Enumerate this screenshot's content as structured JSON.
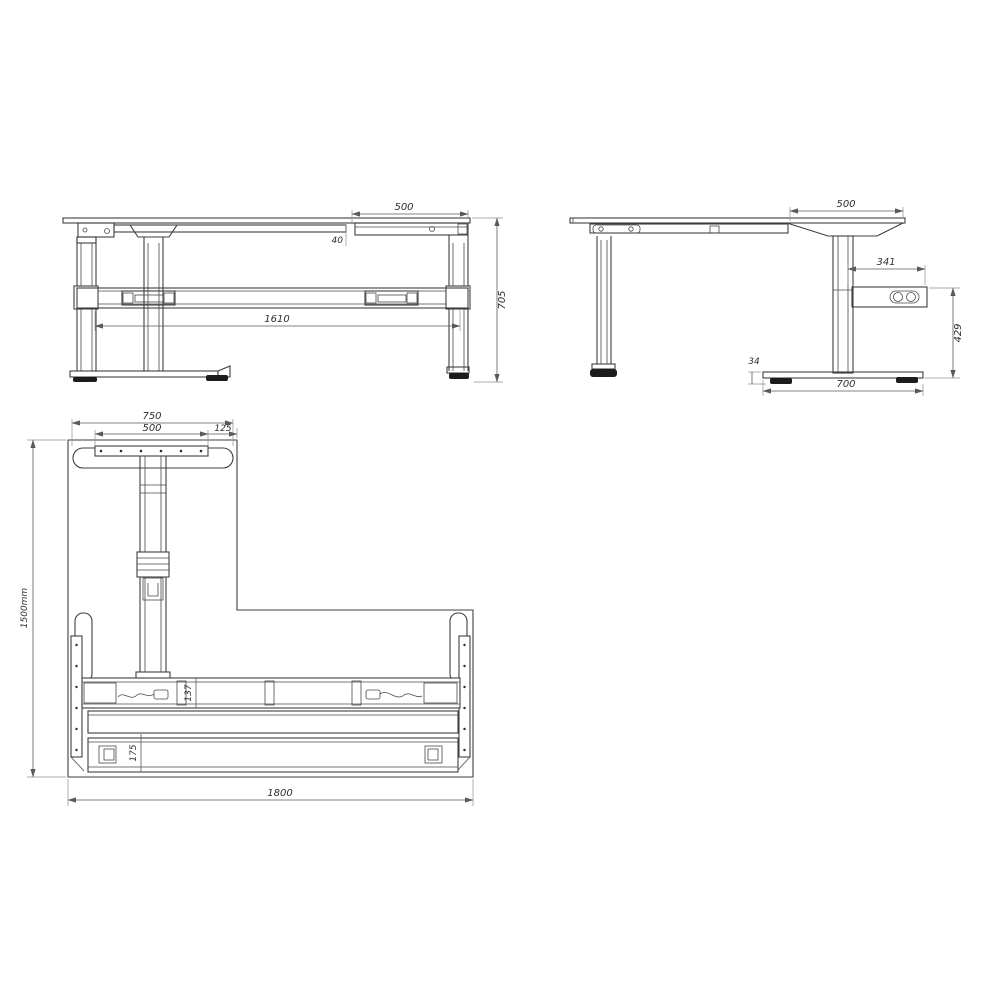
{
  "drawing": {
    "type": "technical-orthographic-drawing",
    "subject": "height-adjustable L-shaped desk frame, three views (front elevation, side elevation, plan)",
    "colors": {
      "background": "#ffffff",
      "line": "#3f3f3f",
      "dimension_line": "#5a5a5a",
      "text": "#2e2e2e",
      "foot_pad": "#1c1c1c"
    }
  },
  "views": {
    "front": {
      "name": "front elevation",
      "dims": {
        "top_segment": "500",
        "gap": "40",
        "span": "1610",
        "height": "705"
      }
    },
    "side": {
      "name": "side elevation",
      "dims": {
        "top_segment": "500",
        "controller_width": "341",
        "controller_drop": "429",
        "foot_height": "34",
        "foot_length": "700"
      }
    },
    "plan": {
      "name": "plan view",
      "dims": {
        "support_width": "750",
        "bracket_width": "500",
        "edge_offset": "125",
        "depth": "1500mm",
        "beam_depth": "137",
        "rail_depth": "175",
        "width": "1800"
      }
    }
  }
}
